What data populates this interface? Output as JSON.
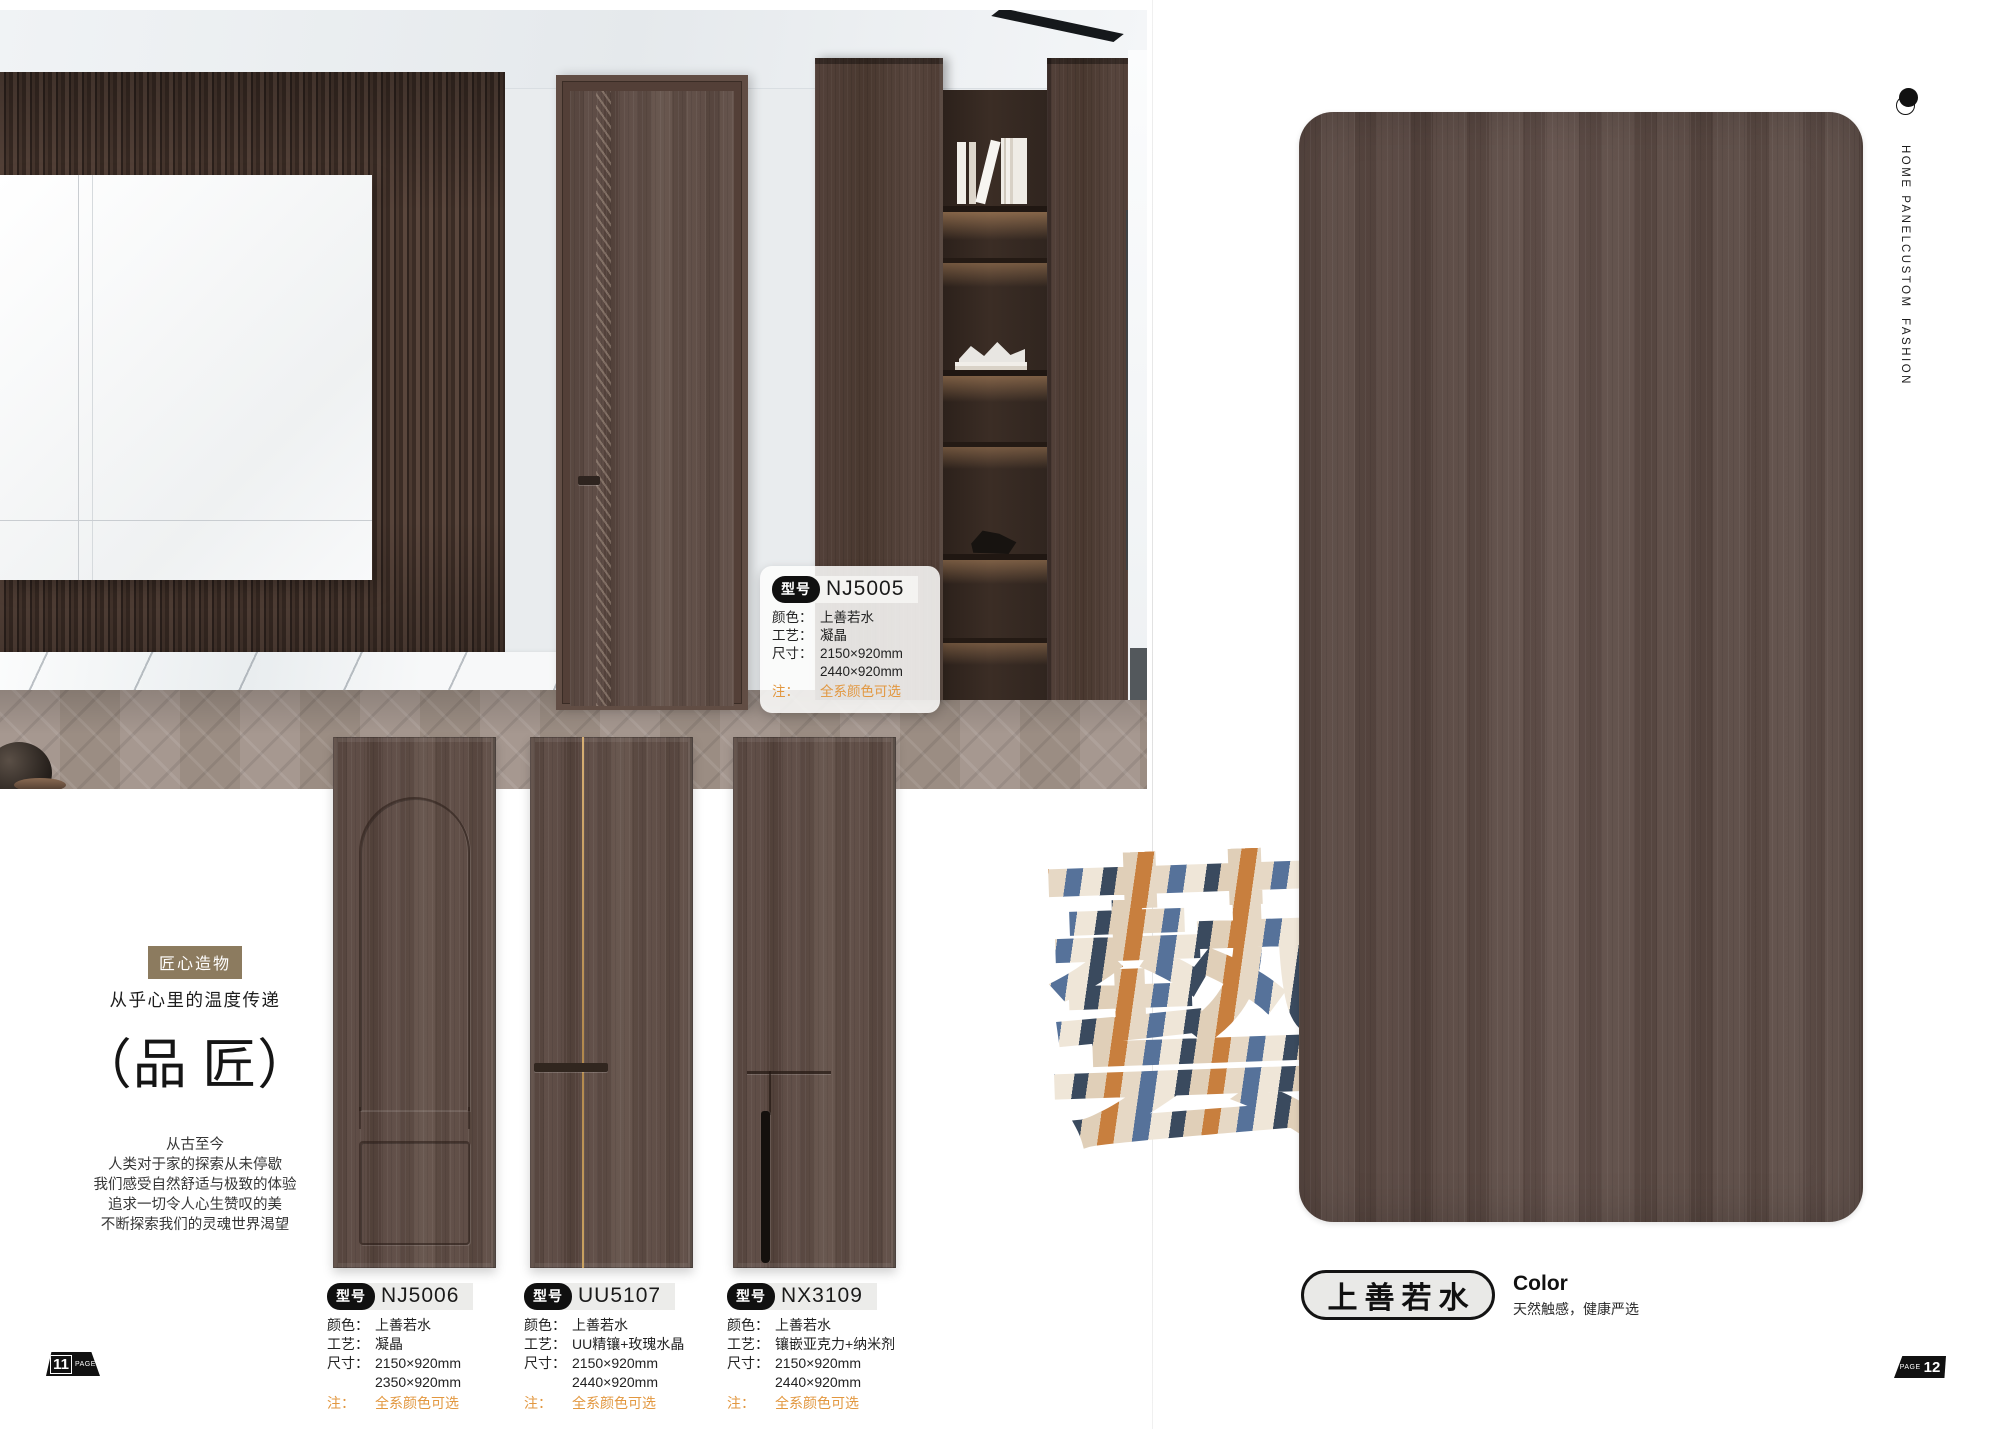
{
  "labels": {
    "model_tag": "型号",
    "color": "颜色：",
    "craft": "工艺：",
    "size": "尺寸：",
    "note": "注："
  },
  "scene_spec": {
    "model": "NJ5005",
    "color": "上善若水",
    "craft": "凝晶",
    "size1": "2150×920mm",
    "size2": "2440×920mm",
    "note": "全系颜色可选"
  },
  "intro": {
    "badge": "匠心造物",
    "subtitle": "从乎心里的温度传递",
    "title": "（品 匠）",
    "lines": [
      "从古至今",
      "人类对于家的探索从未停歇",
      "我们感受自然舒适与极致的体验",
      "追求一切令人心生赞叹的美",
      "不断探索我们的灵魂世界渴望"
    ]
  },
  "products": [
    {
      "model": "NJ5006",
      "color": "上善若水",
      "craft": "凝晶",
      "size1": "2150×920mm",
      "size2": "2350×920mm",
      "note": "全系颜色可选"
    },
    {
      "model": "UU5107",
      "color": "上善若水",
      "craft": "UU精镶+玫瑰水晶",
      "size1": "2150×920mm",
      "size2": "2440×920mm",
      "note": "全系颜色可选"
    },
    {
      "model": "NX3109",
      "color": "上善若水",
      "craft": "镶嵌亚克力+纳米剂",
      "size1": "2150×920mm",
      "size2": "2440×920mm",
      "note": "全系颜色可选"
    }
  ],
  "right_page": {
    "nav": [
      "HOME PANEL",
      "CUSTOM",
      "FASHION"
    ],
    "art_character": "藝",
    "swatch_name": "上善若水",
    "color_label": "Color",
    "color_subtitle": "天然触感，健康严选"
  },
  "page_markers": {
    "left_number": "11",
    "left_label": "PAGE",
    "right_number": "12",
    "right_label": "PAGE"
  },
  "colors": {
    "accent_note": "#e2973f",
    "panel_wood": "#5c4a42",
    "badge_bg": "#8c7b5f"
  }
}
